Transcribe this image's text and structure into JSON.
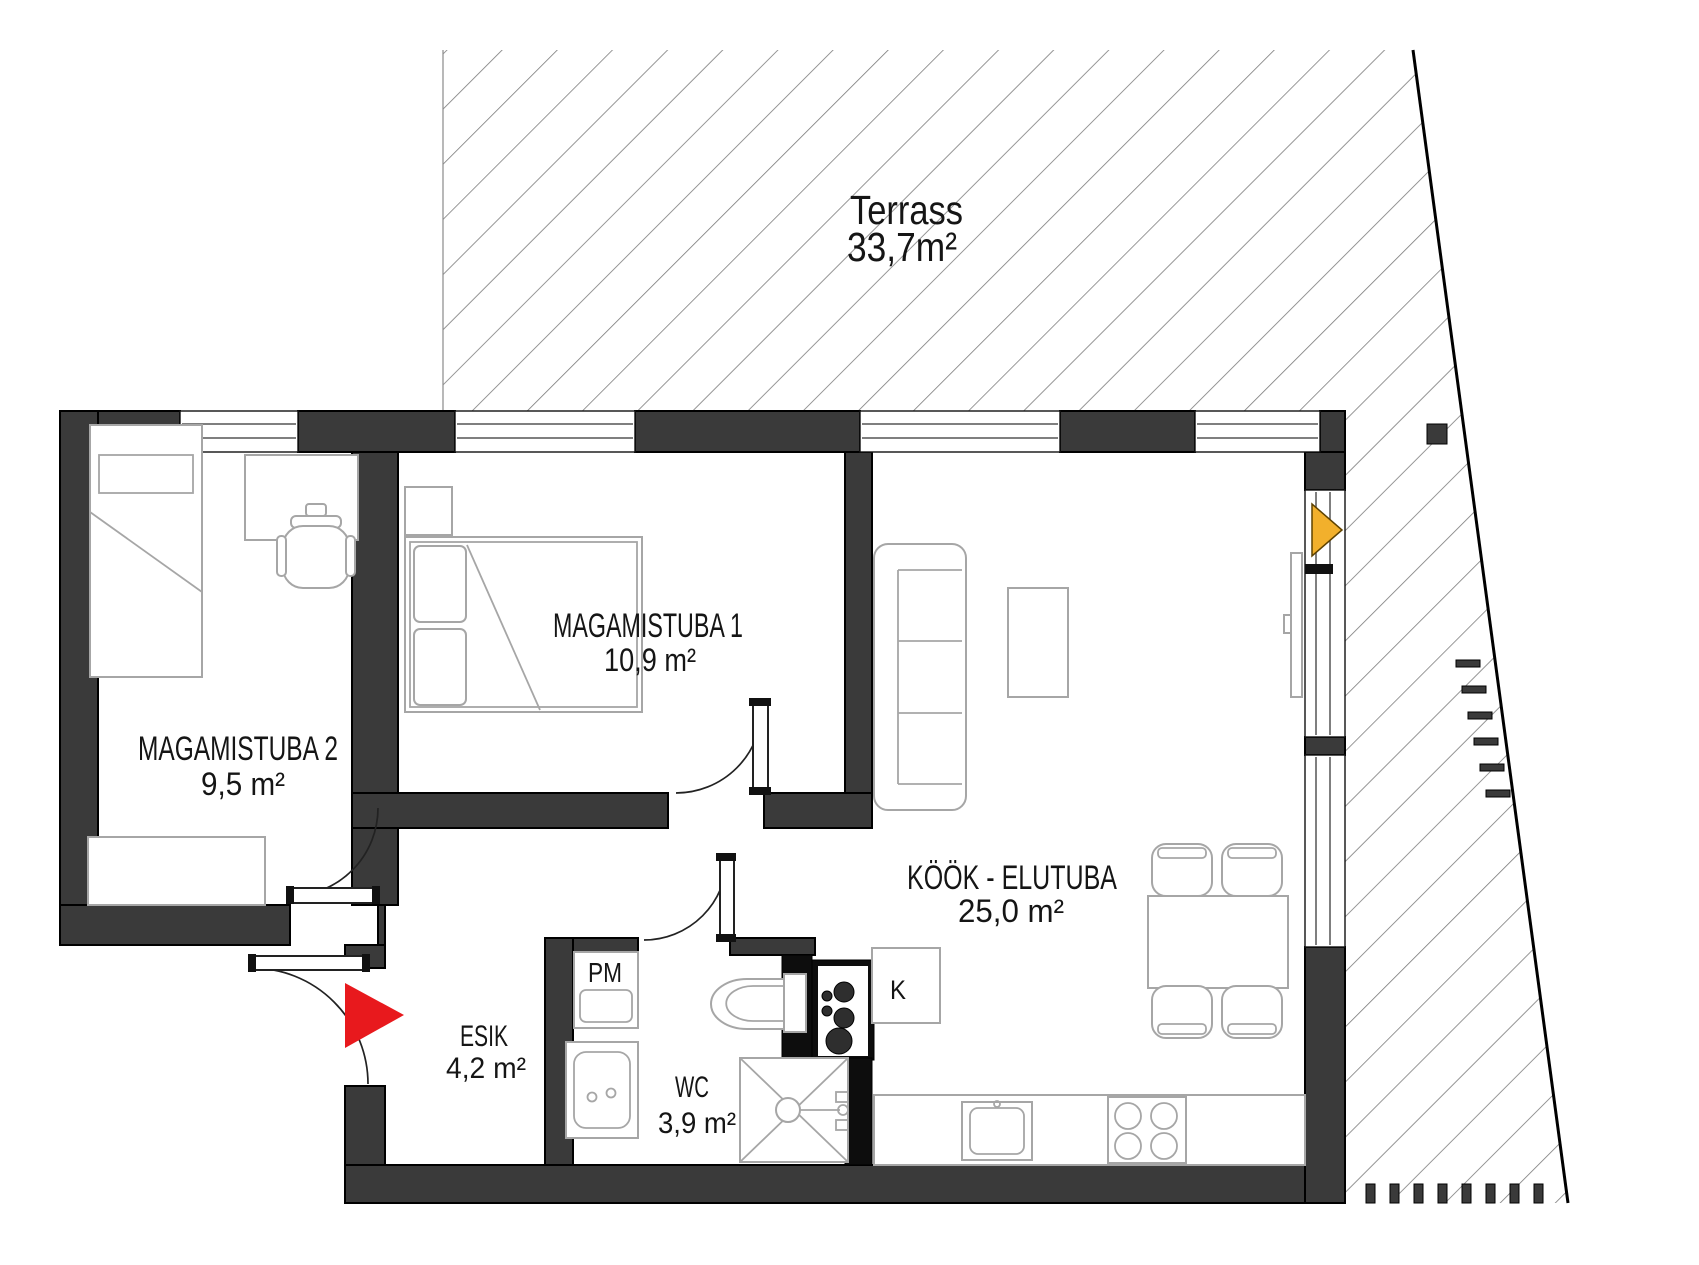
{
  "terrace": {
    "label": "Terrass",
    "area": "33,7m²"
  },
  "rooms": {
    "bedroom1": {
      "label": "MAGAMISTUBA 1",
      "area": "10,9 m²"
    },
    "bedroom2": {
      "label": "MAGAMISTUBA 2",
      "area": "9,5 m²"
    },
    "kitchen_living": {
      "label": "KÖÖK - ELUTUBA",
      "area": "25,0 m²"
    },
    "hallway": {
      "label": "ESIK",
      "area": "4,2 m²"
    },
    "wc": {
      "label": "WC",
      "area": "3,9 m²"
    }
  },
  "appliances": {
    "washing_machine_label": "PM",
    "fridge_label": "K"
  },
  "colors": {
    "wall": "#3a3a3a",
    "wall_black": "#0d0d0d",
    "hatch_line": "#7b7b7b",
    "furniture_line": "#a6a6a6",
    "entry_arrow": "#e8191d",
    "terrace_arrow": "#f2b02c"
  }
}
